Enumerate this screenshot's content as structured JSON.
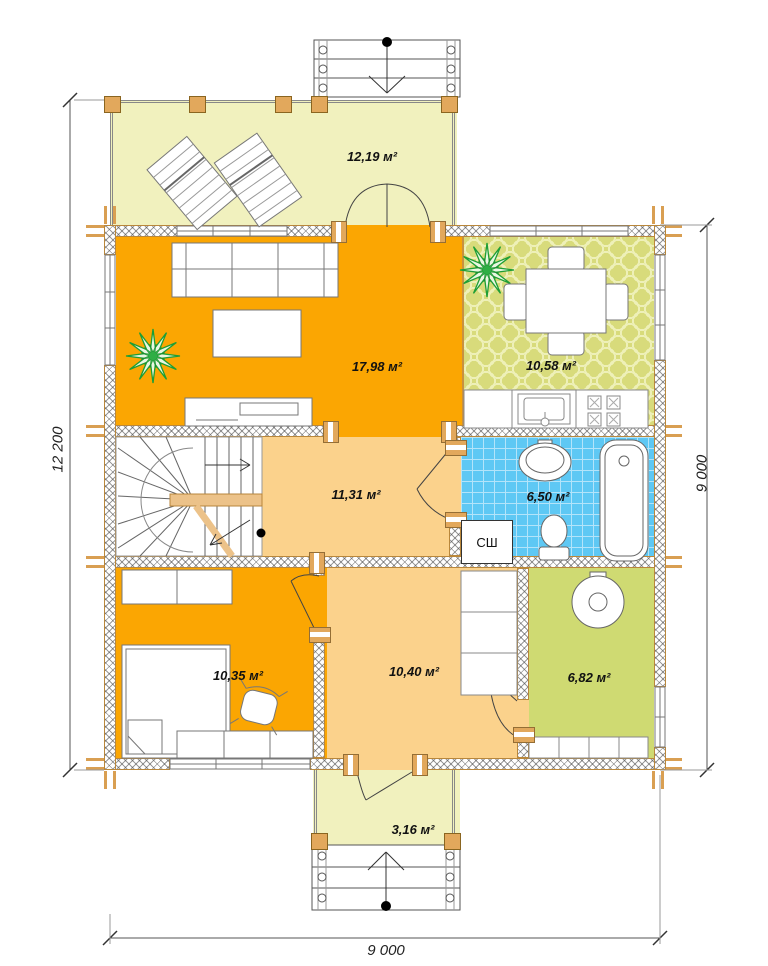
{
  "title": "house-first-floor-plan",
  "colors": {
    "room_orange": "#FBA602",
    "room_peach": "#FBD28C",
    "terrace_pale": "#F1F1BE",
    "kitchen_green": "#D8DB7B",
    "boiler_green": "#CFDA72",
    "bath_blue": "#5EC8F4",
    "wall_tan": "#B9873B",
    "post_tan": "#E2A85C",
    "line_gray": "#666666"
  },
  "rooms": {
    "terrace": {
      "area_label": "12,19 м²"
    },
    "living": {
      "area_label": "17,98 м²"
    },
    "kitchen": {
      "area_label": "10,58 м²"
    },
    "hall": {
      "area_label": "11,31 м²"
    },
    "bathroom": {
      "area_label": "6,50 м²"
    },
    "bedroom": {
      "area_label": "10,35 м²"
    },
    "back_hall": {
      "area_label": "10,40 м²"
    },
    "boiler": {
      "area_label": "6,82 м²"
    },
    "porch": {
      "area_label": "3,16 м²"
    }
  },
  "labels": {
    "dryer_cabinet": "СШ"
  },
  "dimensions": {
    "left": "12 200",
    "right": "9 000",
    "bottom": "9 000"
  }
}
